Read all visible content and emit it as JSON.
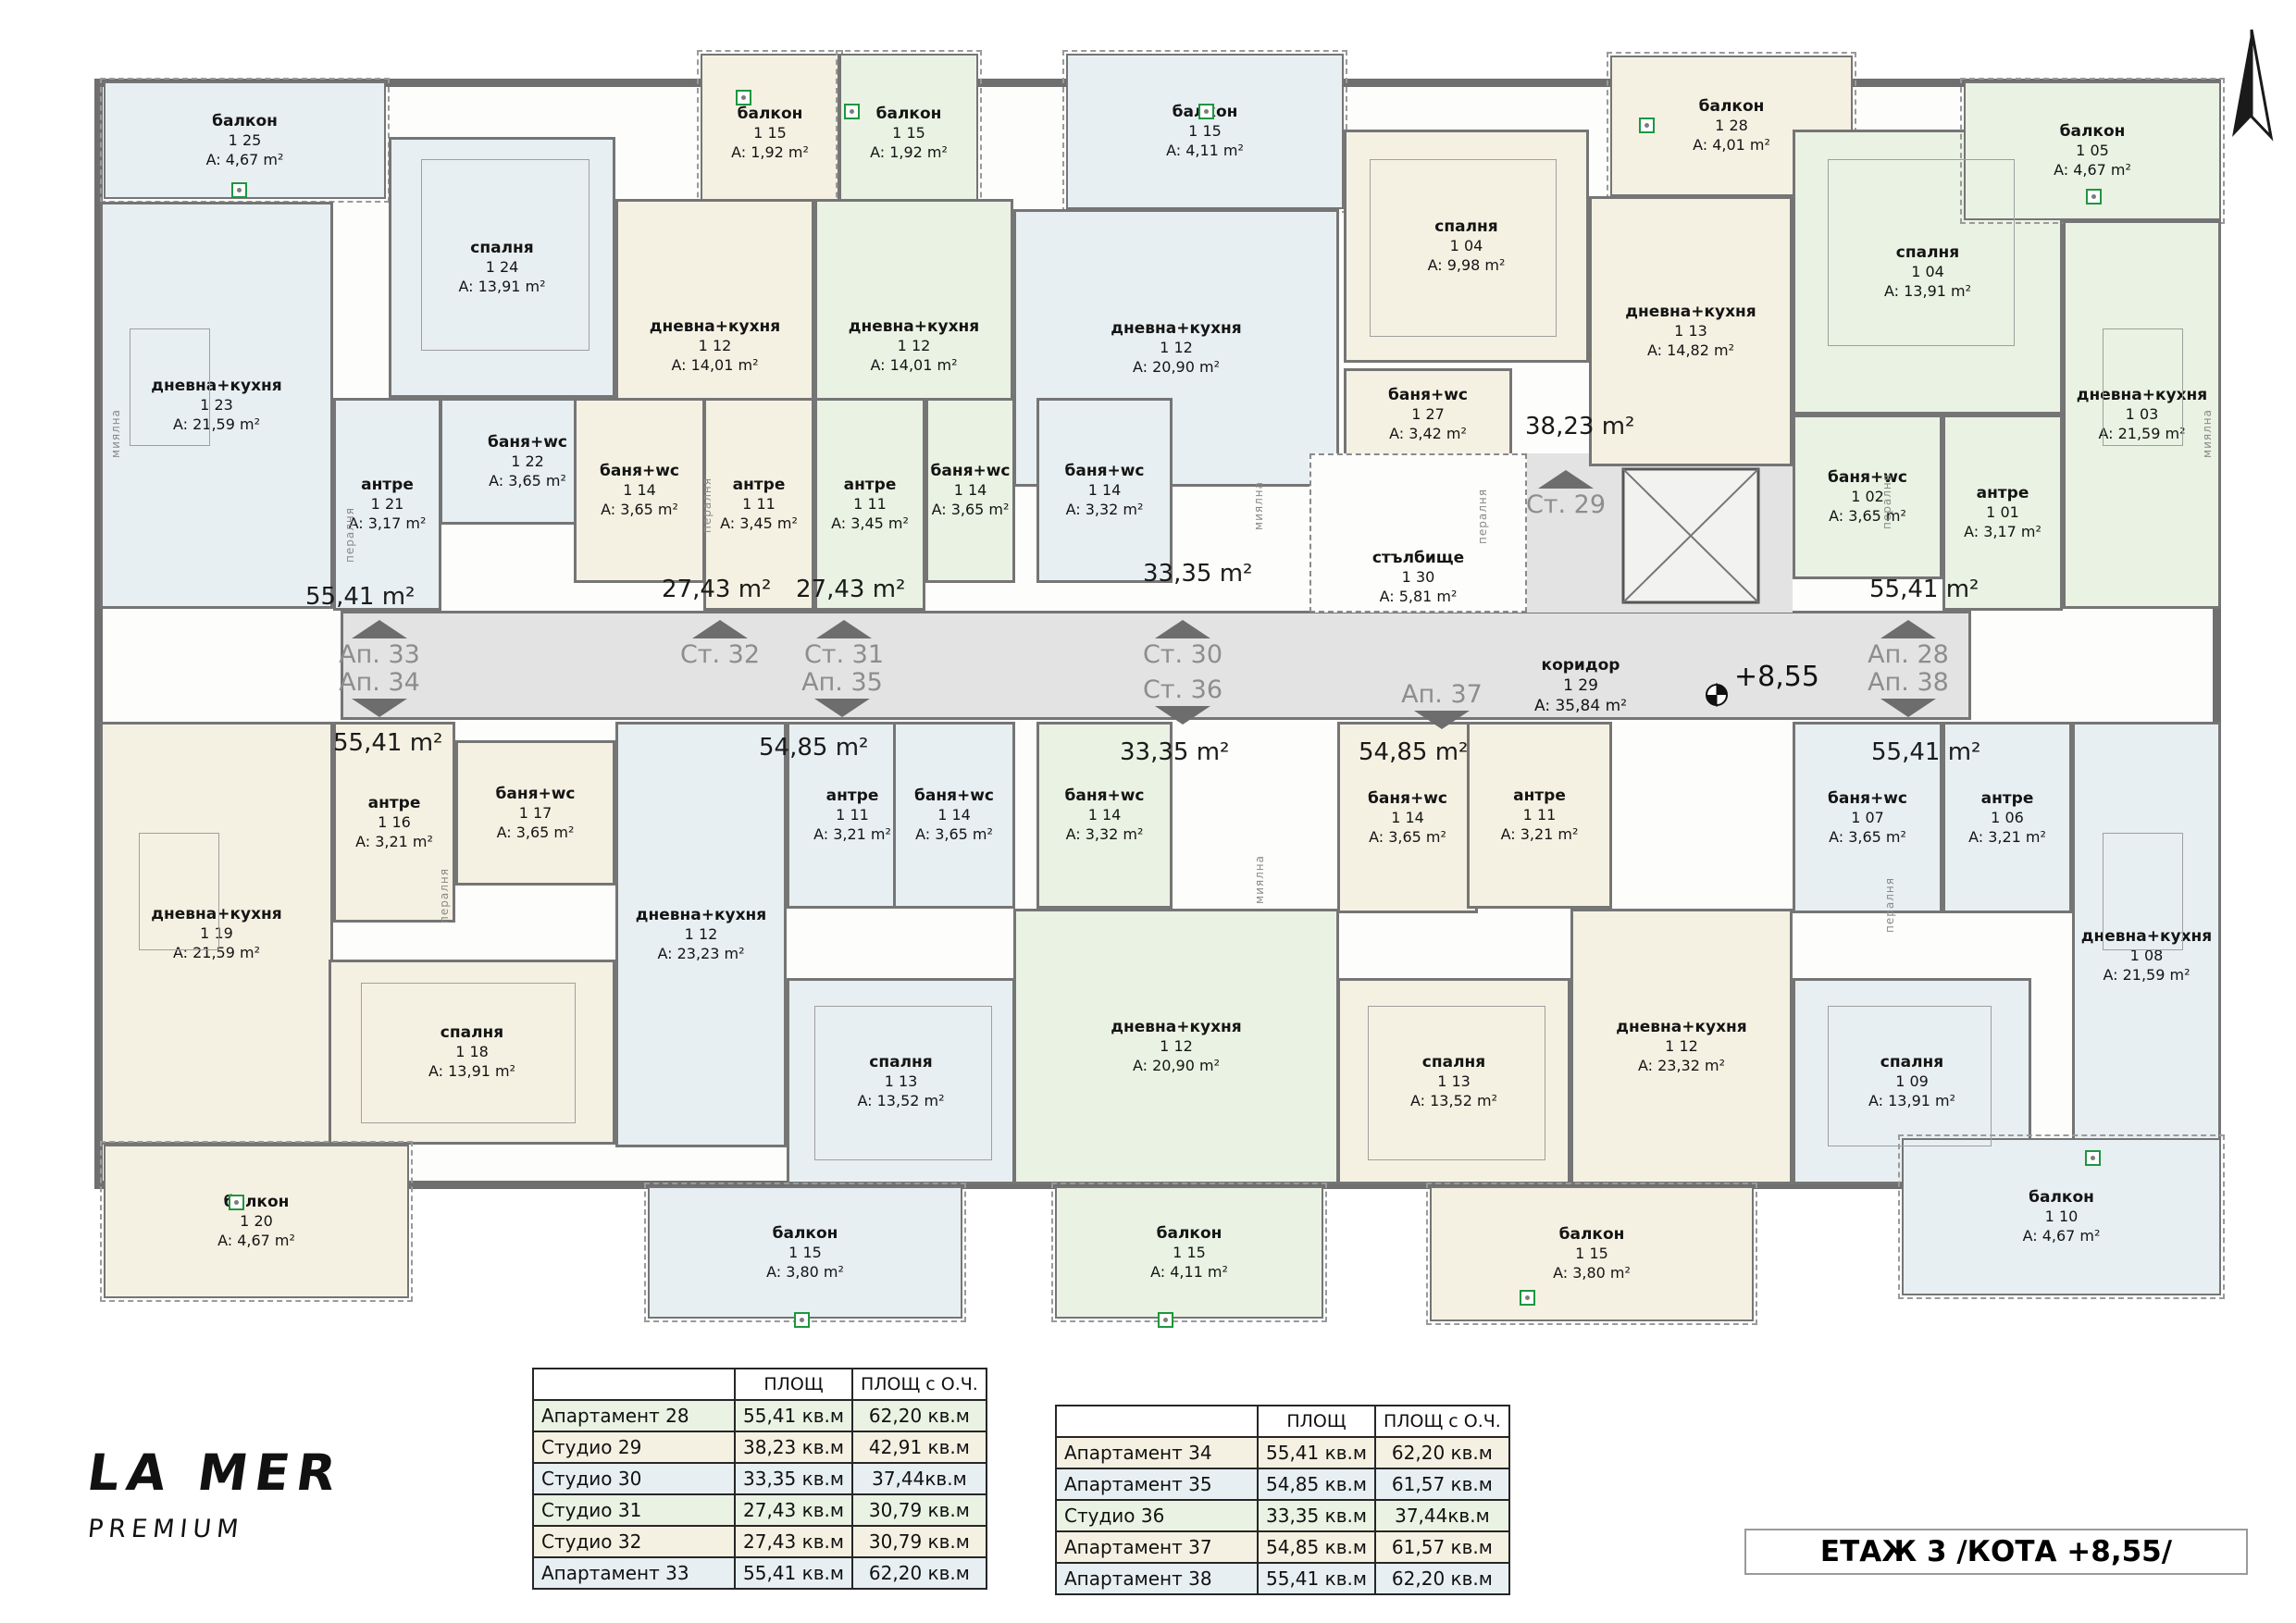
{
  "palette": {
    "cream": "#f5f1e2",
    "green": "#eaf2e3",
    "blue": "#e7eff2",
    "corridor": "#e3e3e3",
    "wall": "#757575",
    "label_gray": "#8d8d8d",
    "accent_green": "#1e9640",
    "white": "#fdfdfc"
  },
  "logo": {
    "title": "LA MER",
    "subtitle": "PREMIUM"
  },
  "title_block": "ЕТАЖ 3 /КОТА +8,55/",
  "level_mark": "+8,55",
  "icons": {
    "north": "north-arrow",
    "benchmark": "level-benchmark",
    "vent": "vent-icon"
  },
  "corridor": {
    "name": "коридор",
    "num": "1 29",
    "area": "A: 35,84 m²"
  },
  "rooms": [
    {
      "id": "balk25",
      "name": "балкон",
      "num": "1 25",
      "area": "A: 4,67 m²"
    },
    {
      "id": "dk23",
      "name": "дневна+кухня",
      "num": "1 23",
      "area": "A: 21,59 m²"
    },
    {
      "id": "sp24",
      "name": "спалня",
      "num": "1 24",
      "area": "A: 13,91 m²"
    },
    {
      "id": "antre21",
      "name": "антре",
      "num": "1 21",
      "area": "A: 3,17 m²"
    },
    {
      "id": "bw22",
      "name": "баня+wc",
      "num": "1 22",
      "area": "A: 3,65 m²"
    },
    {
      "id": "balk15_32",
      "name": "балкон",
      "num": "1 15",
      "area": "A: 1,92 m²"
    },
    {
      "id": "dk12_32",
      "name": "дневна+кухня",
      "num": "1 12",
      "area": "A: 14,01 m²"
    },
    {
      "id": "bw14_32",
      "name": "баня+wc",
      "num": "1 14",
      "area": "A: 3,65 m²"
    },
    {
      "id": "antre11_32",
      "name": "антре",
      "num": "1 11",
      "area": "A: 3,45 m²"
    },
    {
      "id": "balk15_31",
      "name": "балкон",
      "num": "1 15",
      "area": "A: 1,92 m²"
    },
    {
      "id": "dk12_31",
      "name": "дневна+кухня",
      "num": "1 12",
      "area": "A: 14,01 m²"
    },
    {
      "id": "antre11_31",
      "name": "антре",
      "num": "1 11",
      "area": "A: 3,45 m²"
    },
    {
      "id": "bw14_31",
      "name": "баня+wc",
      "num": "1 14",
      "area": "A: 3,65 m²"
    },
    {
      "id": "balk15_30",
      "name": "балкон",
      "num": "1 15",
      "area": "A: 4,11 m²"
    },
    {
      "id": "dk12_30",
      "name": "дневна+кухня",
      "num": "1 12",
      "area": "A: 20,90 m²"
    },
    {
      "id": "bw14_30",
      "name": "баня+wc",
      "num": "1 14",
      "area": "A: 3,32 m²"
    },
    {
      "id": "sp04_29",
      "name": "спалня",
      "num": "1 04",
      "area": "A: 9,98 m²"
    },
    {
      "id": "bw27",
      "name": "баня+wc",
      "num": "1 27",
      "area": "A: 3,42 m²"
    },
    {
      "id": "balk28",
      "name": "балкон",
      "num": "1 28",
      "area": "A: 4,01 m²"
    },
    {
      "id": "dk13_29",
      "name": "дневна+кухня",
      "num": "1 13",
      "area": "A: 14,82 m²"
    },
    {
      "id": "sp04_28",
      "name": "спалня",
      "num": "1 04",
      "area": "A: 13,91 m²"
    },
    {
      "id": "balk05",
      "name": "балкон",
      "num": "1 05",
      "area": "A: 4,67 m²"
    },
    {
      "id": "dk03",
      "name": "дневна+кухня",
      "num": "1 03",
      "area": "A: 21,59 m²"
    },
    {
      "id": "bw02",
      "name": "баня+wc",
      "num": "1 02",
      "area": "A: 3,65 m²"
    },
    {
      "id": "antre01",
      "name": "антре",
      "num": "1 01",
      "area": "A: 3,17 m²"
    },
    {
      "id": "stair",
      "name": "стълбище",
      "num": "1 30",
      "area": "A: 5,81 m²"
    },
    {
      "id": "dk19",
      "name": "дневна+кухня",
      "num": "1 19",
      "area": "A: 21,59 m²"
    },
    {
      "id": "antre16",
      "name": "антре",
      "num": "1 16",
      "area": "A: 3,21 m²"
    },
    {
      "id": "bw17",
      "name": "баня+wc",
      "num": "1 17",
      "area": "A: 3,65 m²"
    },
    {
      "id": "sp18",
      "name": "спалня",
      "num": "1 18",
      "area": "A: 13,91 m²"
    },
    {
      "id": "balk20",
      "name": "балкон",
      "num": "1 20",
      "area": "A: 4,67 m²"
    },
    {
      "id": "dk12_35",
      "name": "дневна+кухня",
      "num": "1 12",
      "area": "A: 23,23 m²"
    },
    {
      "id": "antre11_35",
      "name": "антре",
      "num": "1 11",
      "area": "A: 3,21 m²"
    },
    {
      "id": "bw14_35",
      "name": "баня+wc",
      "num": "1 14",
      "area": "A: 3,65 m²"
    },
    {
      "id": "sp13_35",
      "name": "спалня",
      "num": "1 13",
      "area": "A: 13,52 m²"
    },
    {
      "id": "balk15_35",
      "name": "балкон",
      "num": "1 15",
      "area": "A: 3,80 m²"
    },
    {
      "id": "bw14_36",
      "name": "баня+wc",
      "num": "1 14",
      "area": "A: 3,32 m²"
    },
    {
      "id": "dk12_36",
      "name": "дневна+кухня",
      "num": "1 12",
      "area": "A: 20,90 m²"
    },
    {
      "id": "balk15_36",
      "name": "балкон",
      "num": "1 15",
      "area": "A: 4,11 m²"
    },
    {
      "id": "bw14_37",
      "name": "баня+wc",
      "num": "1 14",
      "area": "A: 3,65 m²"
    },
    {
      "id": "antre11_37",
      "name": "антре",
      "num": "1 11",
      "area": "A: 3,21 m²"
    },
    {
      "id": "dk12_37",
      "name": "дневна+кухня",
      "num": "1 12",
      "area": "A: 23,32 m²"
    },
    {
      "id": "sp13_37",
      "name": "спалня",
      "num": "1 13",
      "area": "A: 13,52 m²"
    },
    {
      "id": "balk15_37",
      "name": "балкон",
      "num": "1 15",
      "area": "A: 3,80 m²"
    },
    {
      "id": "bw07",
      "name": "баня+wc",
      "num": "1 07",
      "area": "A: 3,65 m²"
    },
    {
      "id": "antre06",
      "name": "антре",
      "num": "1 06",
      "area": "A: 3,21 m²"
    },
    {
      "id": "sp09",
      "name": "спалня",
      "num": "1 09",
      "area": "A: 13,91 m²"
    },
    {
      "id": "dk08",
      "name": "дневна+кухня",
      "num": "1 08",
      "area": "A: 21,59 m²"
    },
    {
      "id": "balk10",
      "name": "балкон",
      "num": "1 10",
      "area": "A: 4,67 m²"
    }
  ],
  "area_marks": [
    {
      "id": "a1",
      "text": "55,41 m²"
    },
    {
      "id": "a2",
      "text": "27,43 m²"
    },
    {
      "id": "a3",
      "text": "27,43 m²"
    },
    {
      "id": "a4",
      "text": "33,35 m²"
    },
    {
      "id": "a5",
      "text": "38,23 m²"
    },
    {
      "id": "a6",
      "text": "55,41 m²"
    },
    {
      "id": "a7",
      "text": "55,41 m²"
    },
    {
      "id": "a8",
      "text": "54,85 m²"
    },
    {
      "id": "a9",
      "text": "33,35 m²"
    },
    {
      "id": "a10",
      "text": "54,85 m²"
    },
    {
      "id": "a11",
      "text": "55,41 m²"
    }
  ],
  "corridor_labels": [
    {
      "id": "ap33",
      "text": "Ап. 33",
      "dir": "up"
    },
    {
      "id": "st32",
      "text": "Ст. 32",
      "dir": "up"
    },
    {
      "id": "st31",
      "text": "Ст. 31",
      "dir": "up"
    },
    {
      "id": "st30",
      "text": "Ст. 30",
      "dir": "up"
    },
    {
      "id": "st29",
      "text": "Ст. 29",
      "dir": "up"
    },
    {
      "id": "ap28",
      "text": "Ап. 28",
      "dir": "up"
    },
    {
      "id": "ap34",
      "text": "Ап. 34",
      "dir": "down"
    },
    {
      "id": "ap35",
      "text": "Ап. 35",
      "dir": "down"
    },
    {
      "id": "st36",
      "text": "Ст. 36",
      "dir": "down"
    },
    {
      "id": "ap37",
      "text": "Ап. 37",
      "dir": "down"
    },
    {
      "id": "ap38",
      "text": "Ап. 38",
      "dir": "down"
    }
  ],
  "fixtures": [
    {
      "id": "f1",
      "text": "пералня"
    },
    {
      "id": "f2",
      "text": "пералня"
    },
    {
      "id": "f3",
      "text": "пералня"
    },
    {
      "id": "f4",
      "text": "пералня"
    },
    {
      "id": "f5",
      "text": "пералня"
    },
    {
      "id": "f6",
      "text": "пералня"
    },
    {
      "id": "f7",
      "text": "миялна"
    },
    {
      "id": "f8",
      "text": "миялна"
    },
    {
      "id": "f9",
      "text": "миялна"
    },
    {
      "id": "f10",
      "text": "миялна"
    }
  ],
  "tables": {
    "left": {
      "headers": [
        "",
        "ПЛОЩ",
        "ПЛОЩ с О.Ч."
      ],
      "rows": [
        {
          "name": "Апартамент 28",
          "area": "55,41 кв.м",
          "area_total": "62,20 кв.м"
        },
        {
          "name": "Студио 29",
          "area": "38,23 кв.м",
          "area_total": "42,91 кв.м"
        },
        {
          "name": "Студио 30",
          "area": "33,35 кв.м",
          "area_total": "37,44кв.м"
        },
        {
          "name": "Студио 31",
          "area": "27,43 кв.м",
          "area_total": "30,79 кв.м"
        },
        {
          "name": "Студио 32",
          "area": "27,43 кв.м",
          "area_total": "30,79 кв.м"
        },
        {
          "name": "Апартамент 33",
          "area": "55,41 кв.м",
          "area_total": "62,20 кв.м"
        }
      ]
    },
    "right": {
      "headers": [
        "",
        "ПЛОЩ",
        "ПЛОЩ с О.Ч."
      ],
      "rows": [
        {
          "name": "Апартамент 34",
          "area": "55,41 кв.м",
          "area_total": "62,20 кв.м"
        },
        {
          "name": "Апартамент 35",
          "area": "54,85 кв.м",
          "area_total": "61,57 кв.м"
        },
        {
          "name": "Студио 36",
          "area": "33,35 кв.м",
          "area_total": "37,44кв.м"
        },
        {
          "name": "Апартамент 37",
          "area": "54,85 кв.м",
          "area_total": "61,57 кв.м"
        },
        {
          "name": "Апартамент 38",
          "area": "55,41 кв.м",
          "area_total": "62,20 кв.м"
        }
      ]
    }
  }
}
